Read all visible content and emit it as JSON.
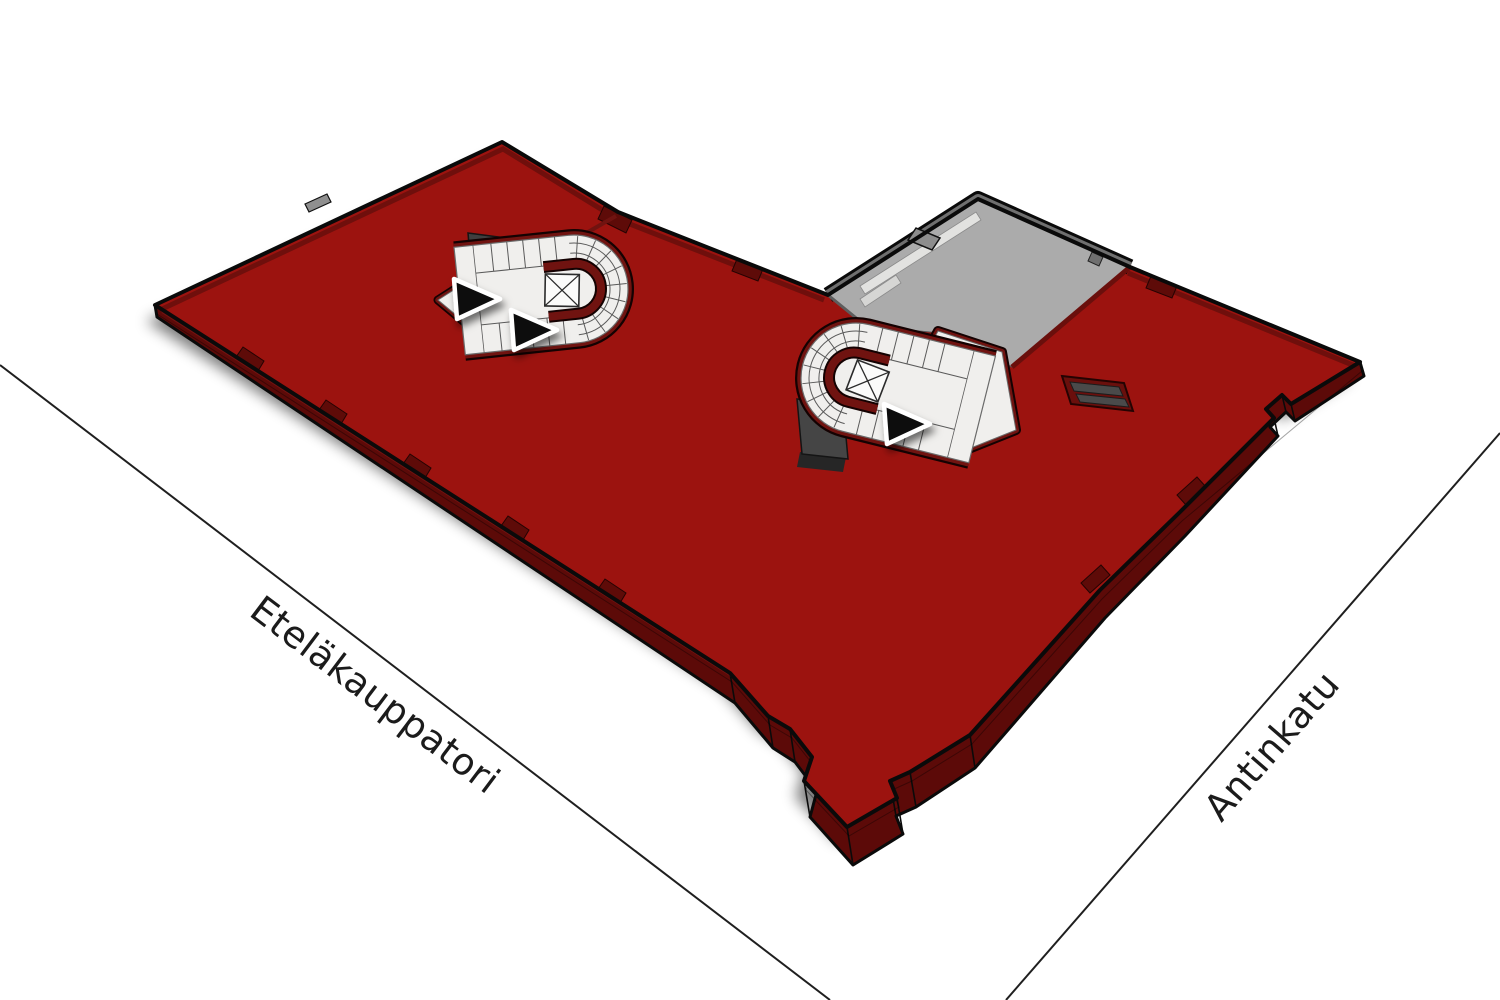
{
  "scene": {
    "description": "3D axonometric floor plan of one building level between two streets",
    "streets": {
      "left_label": "Eteläkauppatori",
      "right_label": "Antinkatu"
    },
    "building": {
      "highlighted_floor": "red-floor-plate",
      "stairwells": [
        {
          "id": "west-stairwell",
          "elevator": true,
          "arrow_count": 2
        },
        {
          "id": "east-stairwell",
          "elevator": true,
          "arrow_count": 1
        }
      ],
      "annex": {
        "id": "courtyard-annex"
      },
      "arrow_total": 3
    },
    "colors": {
      "background": "#ffffff",
      "floor_top": "#9c130f",
      "floor_side": "#5c0a08",
      "wall_dark_red": "#701310",
      "annex_floor": "#ababab",
      "annex_wall": "#6f6f6f",
      "annex_walkway": "#e2e2e0",
      "stair_floor": "#f0efed",
      "stair_line": "#5a5a5a",
      "shaft_gray": "#454545",
      "arrow_fill": "#0d0d0d",
      "street_line": "#1f1f1f",
      "label_text": "#1b1b1b"
    }
  }
}
